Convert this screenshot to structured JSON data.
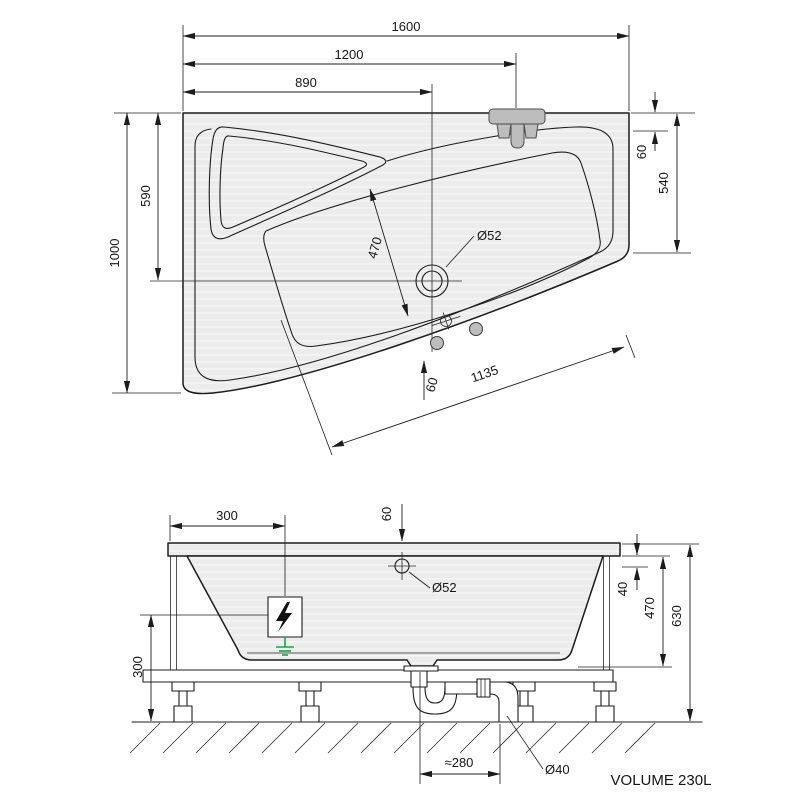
{
  "top_view": {
    "dims": {
      "overall_length": "1600",
      "faucet_position": "1200",
      "drain_position_x": "890",
      "overall_width": "1000",
      "drain_position_y": "590",
      "rim_offset_right": "60",
      "right_side_length": "540",
      "drain_diameter": "Ø52",
      "basin_width": "470",
      "front_edge_offset": "60",
      "front_edge_length": "1135"
    }
  },
  "side_view": {
    "dims": {
      "electric_box_offset": "300",
      "overflow_top_offset": "60",
      "overflow_diameter": "Ø52",
      "rim_drop": "40",
      "shell_depth": "470",
      "overall_height": "630",
      "clearance_height": "300",
      "waste_horizontal_offset": "≈280",
      "waste_pipe_diameter": "Ø40"
    },
    "volume_note": "VOLUME 230L"
  },
  "colors": {
    "ground": "#19a74b",
    "fixture": "#bdbdbd",
    "line": "#1c1c1c"
  }
}
